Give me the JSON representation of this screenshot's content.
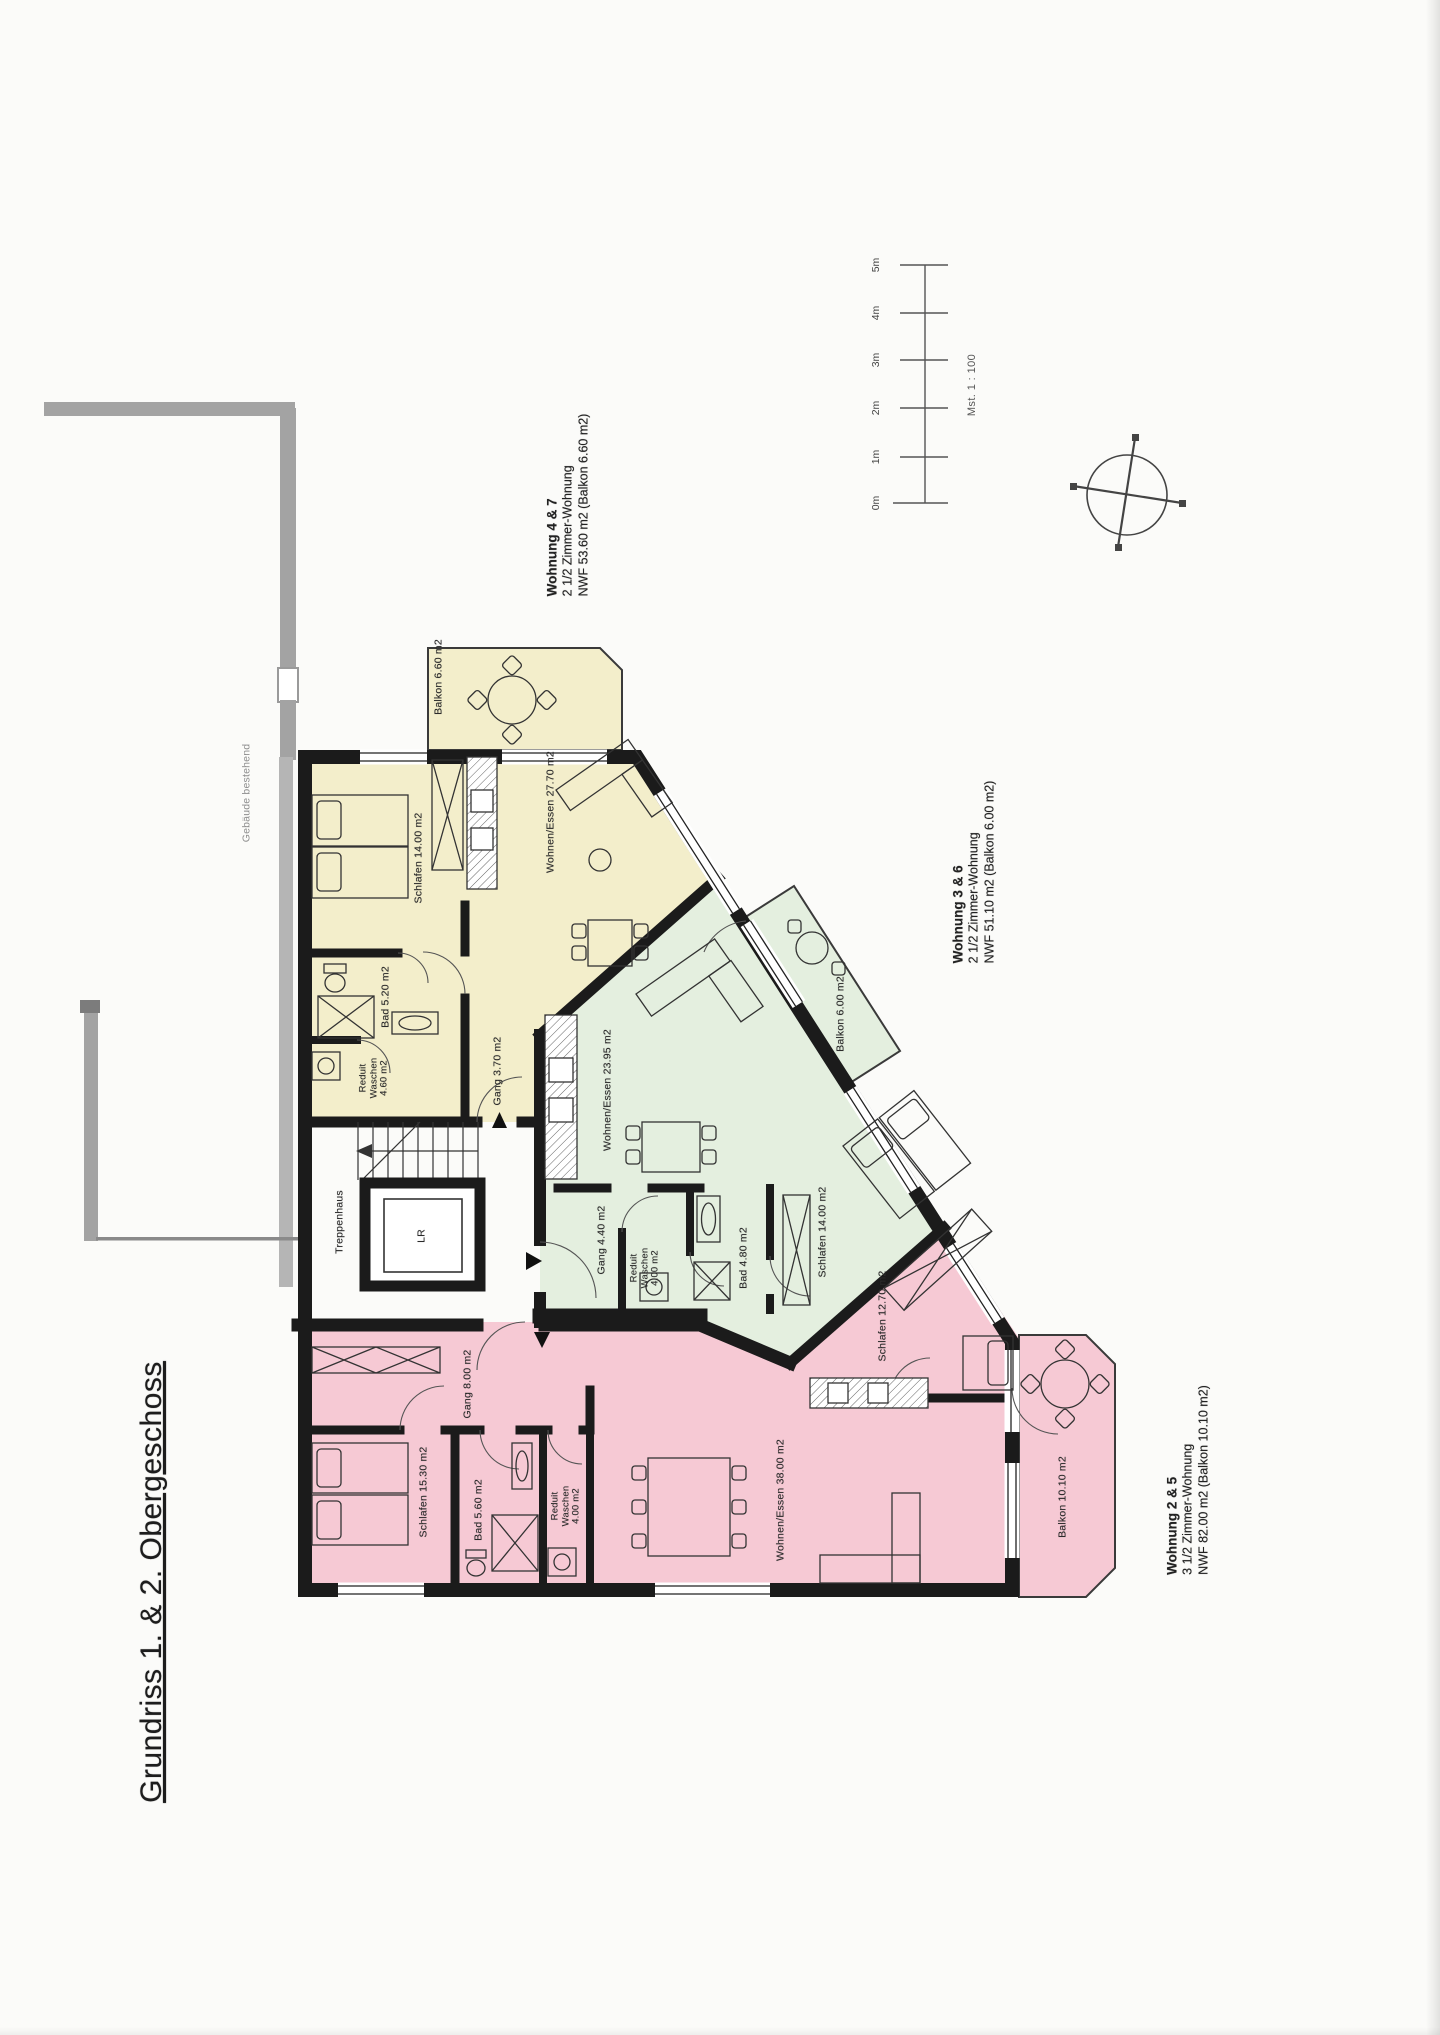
{
  "page": {
    "title": "Grundriss 1. & 2. Obergeschoss"
  },
  "scale_bar": {
    "ticks": [
      "0m",
      "1m",
      "2m",
      "3m",
      "4m",
      "5m"
    ],
    "scale_label": "Mst. 1 : 100"
  },
  "existing_building_label": "Gebäude bestehend",
  "core": {
    "stairs_label": "Treppenhaus",
    "lift_label": "LR"
  },
  "colors": {
    "apartment_yellow": "#f3eecb",
    "apartment_green": "#e4efdf",
    "apartment_pink": "#f6c9d4",
    "wall_black": "#1b1b1b",
    "existing_gray": "#a3a3a3"
  },
  "apartments": [
    {
      "name": "Wohnung 4 & 7",
      "type": "2 1/2 Zimmer-Wohnung",
      "area": "NWF 53.60 m2 (Balkon 6.60 m2)",
      "rooms": {
        "balkon": "Balkon 6.60 m2",
        "schlafen": "Schlafen 14.00 m2",
        "wohnen": "Wohnen/Essen 27.70 m2",
        "bad": "Bad 5.20 m2",
        "reduit": "Reduit\nWaschen\n4.60 m2",
        "gang": "Gang 3.70 m2"
      }
    },
    {
      "name": "Wohnung 3 & 6",
      "type": "2 1/2 Zimmer-Wohnung",
      "area": "NWF 51.10 m2 (Balkon 6.00 m2)",
      "rooms": {
        "balkon": "Balkon 6.00 m2",
        "wohnen": "Wohnen/Essen 23.95 m2",
        "gang": "Gang 4.40 m2",
        "reduit": "Reduit\nWaschen\n4.00 m2",
        "bad": "Bad 4.80 m2",
        "schlafen": "Schlafen 14.00 m2"
      }
    },
    {
      "name": "Wohnung 2 & 5",
      "type": "3 1/2 Zimmer-Wohnung",
      "area": "NWF 82.00 m2 (Balkon 10.10 m2)",
      "rooms": {
        "gang": "Gang 8.00 m2",
        "schlafen1": "Schlafen 15.30 m2",
        "bad": "Bad 5.60 m2",
        "reduit": "Reduit\nWaschen\n4.00 m2",
        "wohnen": "Wohnen/Essen 38.00 m2",
        "schlafen2": "Schlafen 12.70 m2",
        "balkon": "Balkon 10.10 m2"
      }
    }
  ]
}
